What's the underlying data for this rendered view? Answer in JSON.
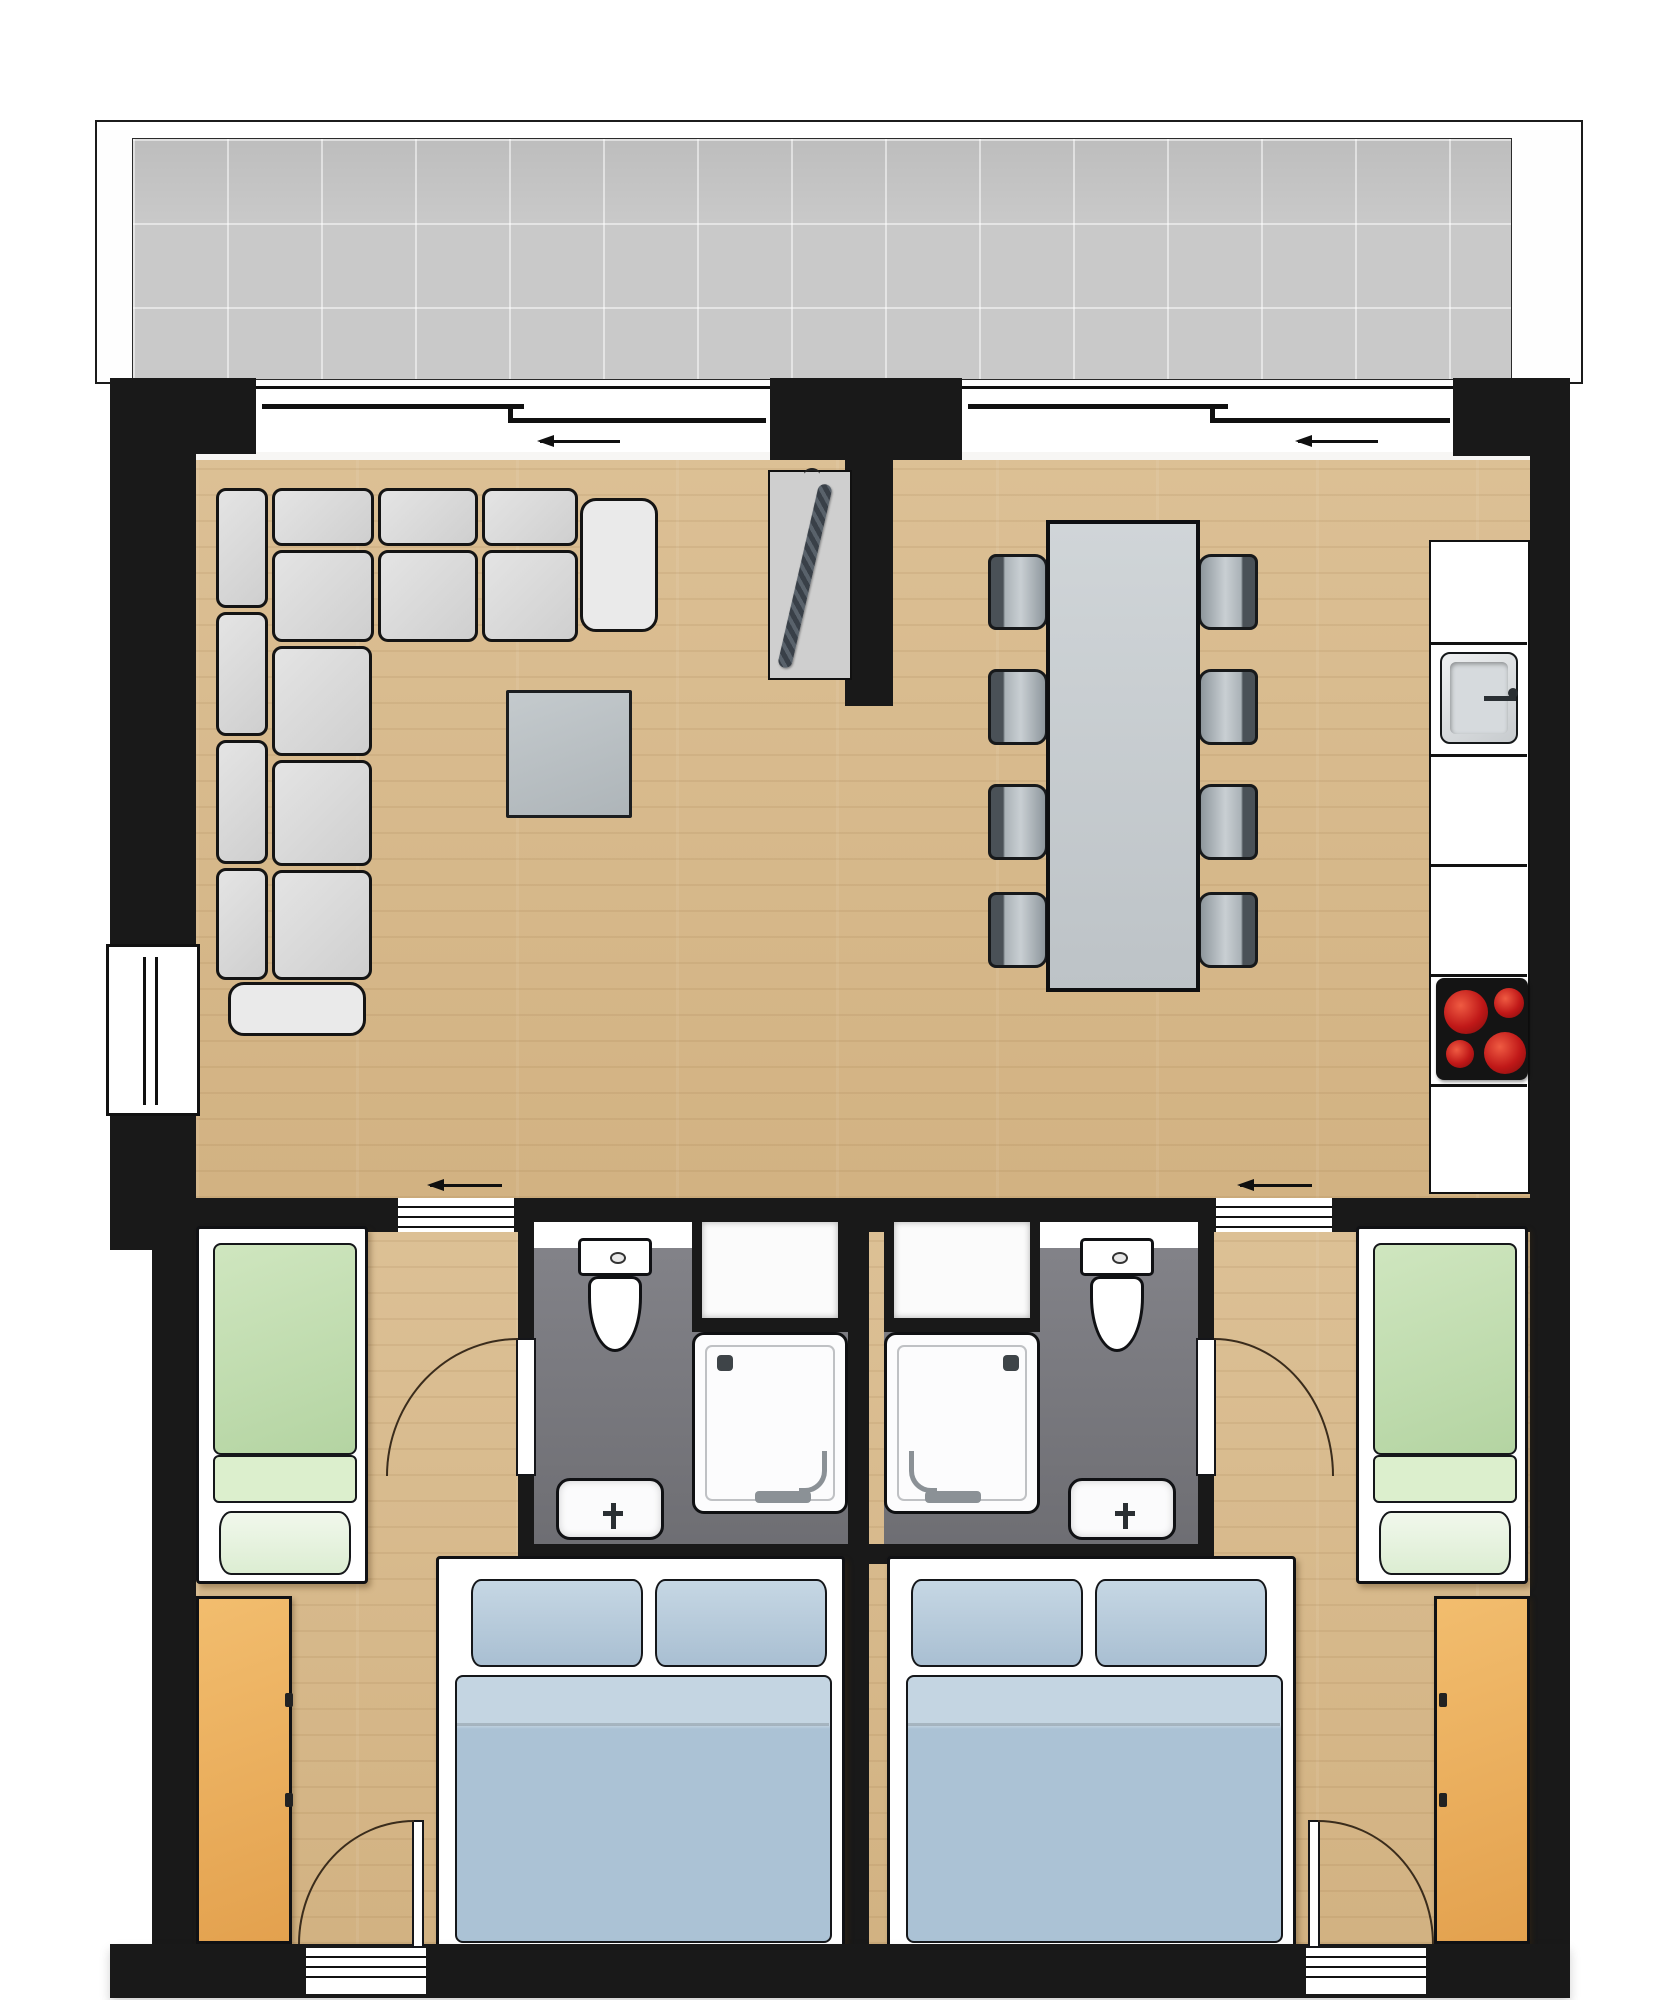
{
  "page": {
    "background": "#ffffff"
  },
  "floor_plan": {
    "kind": "apartment top-down floor plan (no text labels in image)",
    "wall_color": "#191919",
    "wood_floor_color": "#d6b98c",
    "balcony": {
      "label": "balcony",
      "tile_color": "#c9c9c9",
      "tile_grid": true
    },
    "living_area": {
      "label": "open living / dining room",
      "sofa": {
        "type": "L-shaped sofa",
        "color": "#dcdcdc",
        "back_cushions": 7,
        "seat_cushions": 6,
        "armrests": 2
      },
      "coffee_table": {
        "color": "#bcc2c5"
      },
      "coat_rack": {
        "color": "#cfcfcf",
        "hanging_item_color": "#4a525b"
      }
    },
    "dining": {
      "table_color": "#c8cdd0",
      "chairs": 8,
      "chair_color": "#9aa3a9"
    },
    "kitchen": {
      "counter_color": "#ffffff",
      "counter_segments": 6,
      "sink": {
        "material_color": "#d6dadd",
        "faucet": true
      },
      "stove": {
        "color": "#141414",
        "burners": 4,
        "burner_color": "#c01818"
      }
    },
    "bathrooms": [
      {
        "label": "bathroom left",
        "floor_color": "#76767a",
        "fixtures": [
          "toilet",
          "shower",
          "washbasin"
        ],
        "niche_shelf": true,
        "swing_door": true
      },
      {
        "label": "bathroom right",
        "floor_color": "#76767a",
        "fixtures": [
          "toilet",
          "shower",
          "washbasin"
        ],
        "niche_shelf": true,
        "swing_door": true
      }
    ],
    "bedrooms": [
      {
        "label": "bedroom left",
        "single_bed_color": "#bfdcae",
        "double_bed_color": "#abc2d5",
        "wardrobe_color": "#e9ad5f",
        "entry_door": true
      },
      {
        "label": "bedroom right",
        "single_bed_color": "#bfdcae",
        "double_bed_color": "#abc2d5",
        "wardrobe_color": "#e9ad5f",
        "entry_door": true
      }
    ],
    "windows": {
      "balcony_sliding_windows": 2,
      "left_wall_window": 1,
      "slide_direction_arrows_top": 2
    },
    "openings": {
      "sliding_openings_to_bedrooms": 2,
      "slide_direction_arrows_middle": 2,
      "bottom_entry_doors": 2
    },
    "doors": {
      "swing_door_arcs": 4
    }
  }
}
